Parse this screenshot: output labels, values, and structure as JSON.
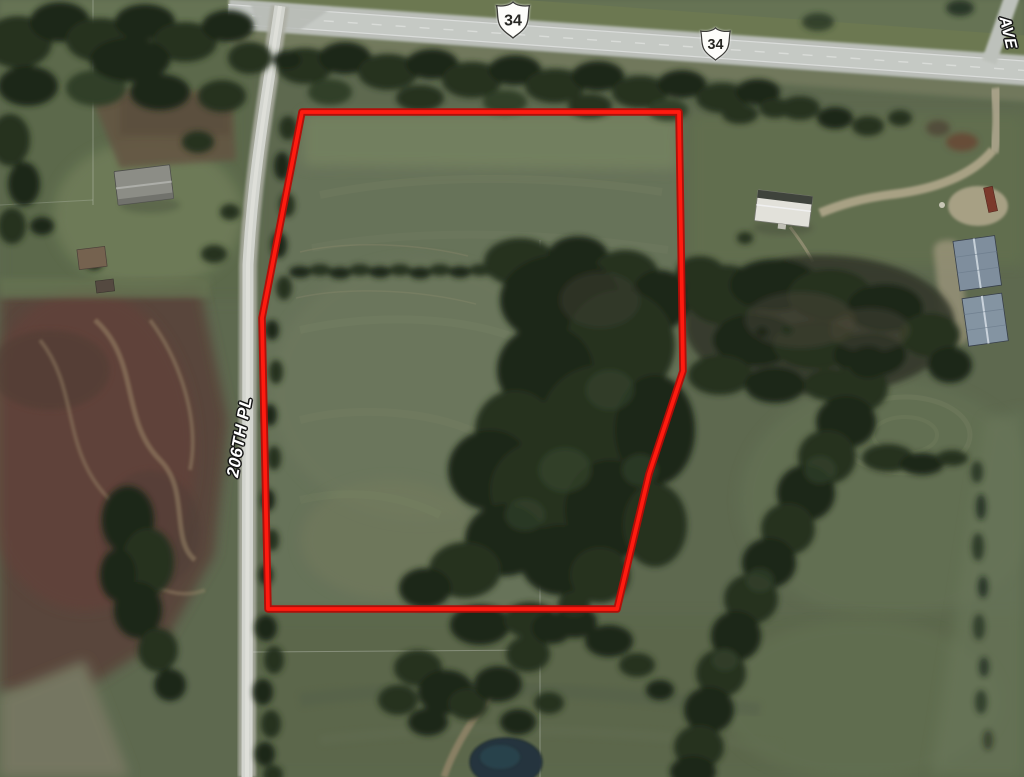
{
  "map": {
    "route_shields": [
      {
        "number": "34"
      },
      {
        "number": "34"
      }
    ],
    "road_labels": [
      {
        "text": "206TH PL"
      },
      {
        "text": "AVE"
      }
    ],
    "boundary": {
      "points": "302,112 679,112 681,240 683,371 649,474 617,609 268,609 262,318",
      "color": "#ff1b10",
      "outline_color": "#b20d08"
    }
  }
}
